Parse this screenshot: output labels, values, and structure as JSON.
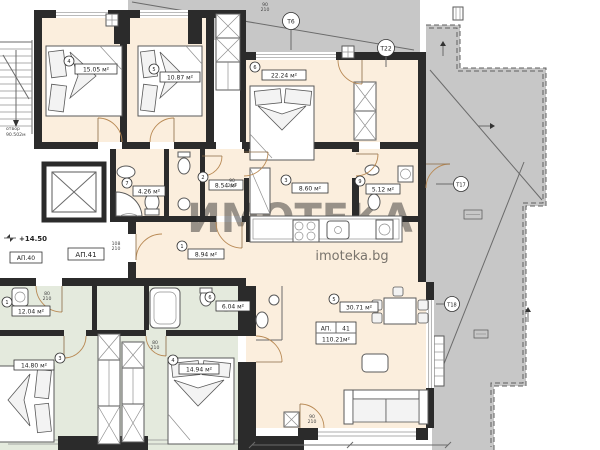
{
  "colors": {
    "room_warm_fill": "#fbeedd",
    "room_cool_fill": "#e4eadd",
    "terrace_fill": "#c7c7c7",
    "wall": "#2b2b2b",
    "door_arc": "#b98a55"
  },
  "watermark": {
    "big": "ИМОТЕКА",
    "small": "imoteka.bg"
  },
  "annotations": {
    "level": "+14.50",
    "ap40": "АП.40",
    "ap41": "АП.41",
    "stair_note": [
      "отвор",
      "90.502м"
    ]
  },
  "title_block": {
    "prefix": "АП.",
    "number": "41",
    "area": "110.21м²"
  },
  "rooms": [
    {
      "num": "4",
      "area": "15.05 м²"
    },
    {
      "num": "5",
      "area": "10.87 м²"
    },
    {
      "num": "6",
      "area": "22.24 м²"
    },
    {
      "num": "7",
      "area": "4.26 м²"
    },
    {
      "num": "2",
      "area": "8.54 м²"
    },
    {
      "num": "3",
      "area": "8.60 м²"
    },
    {
      "num": "9",
      "area": "5.12 м²"
    },
    {
      "num": "1",
      "area": "8.94 м²"
    },
    {
      "num": "5",
      "area": "30.71 м²"
    },
    {
      "num": "1",
      "area": "12.04 м²"
    },
    {
      "num": "6",
      "area": "6.04 м²"
    },
    {
      "num": "3",
      "area": "14.80 м²"
    },
    {
      "num": "4",
      "area": "14.94 м²"
    }
  ],
  "axes": [
    "Т6",
    "Т22",
    "Т17",
    "Т18"
  ],
  "dims": [
    {
      "w": "90",
      "h": "210"
    },
    {
      "w": "90",
      "h": "210"
    },
    {
      "w": "108",
      "h": "210"
    },
    {
      "w": "90",
      "h": "210"
    },
    {
      "w": "80",
      "h": "210"
    },
    {
      "w": "80",
      "h": "210"
    }
  ]
}
